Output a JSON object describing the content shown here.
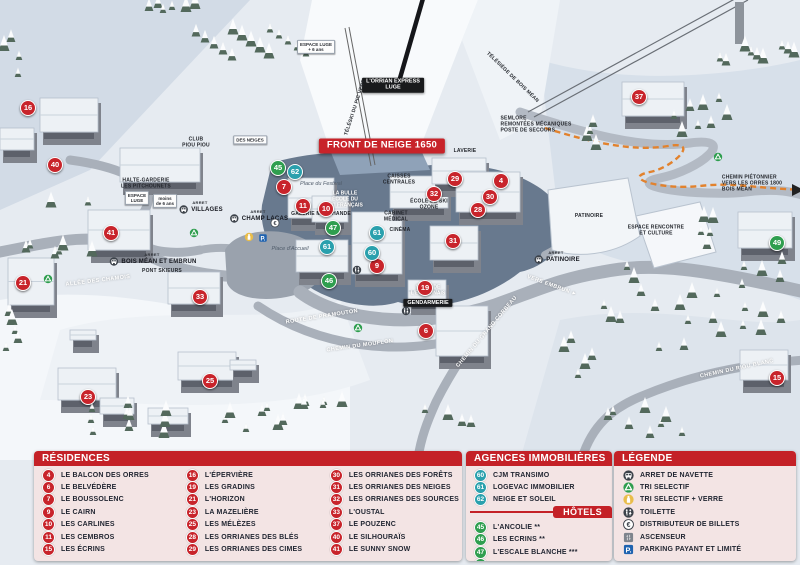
{
  "map": {
    "banner": "FRONT DE NEIGE 1650",
    "colors": {
      "residence_marker": "#c8242b",
      "agency_marker": "#2aa0ad",
      "hotel_marker": "#2f9e4f",
      "banner_red": "#c8232a",
      "pedestrian_path_orange": "#e2822d",
      "panel_pink": "#f3e4e4"
    },
    "markers": [
      {
        "n": "16",
        "kind": "residence",
        "x": 28,
        "y": 108
      },
      {
        "n": "40",
        "kind": "residence",
        "x": 55,
        "y": 165
      },
      {
        "n": "41",
        "kind": "residence",
        "x": 111,
        "y": 233
      },
      {
        "n": "21",
        "kind": "residence",
        "x": 23,
        "y": 283
      },
      {
        "n": "33",
        "kind": "residence",
        "x": 200,
        "y": 297
      },
      {
        "n": "23",
        "kind": "residence",
        "x": 88,
        "y": 397
      },
      {
        "n": "25",
        "kind": "residence",
        "x": 210,
        "y": 381
      },
      {
        "n": "7",
        "kind": "residence",
        "x": 284,
        "y": 187
      },
      {
        "n": "11",
        "kind": "residence",
        "x": 303,
        "y": 206
      },
      {
        "n": "10",
        "kind": "residence",
        "x": 326,
        "y": 209
      },
      {
        "n": "9",
        "kind": "residence",
        "x": 377,
        "y": 266
      },
      {
        "n": "19",
        "kind": "residence",
        "x": 425,
        "y": 288
      },
      {
        "n": "6",
        "kind": "residence",
        "x": 426,
        "y": 331
      },
      {
        "n": "31",
        "kind": "residence",
        "x": 453,
        "y": 241
      },
      {
        "n": "28",
        "kind": "residence",
        "x": 478,
        "y": 210
      },
      {
        "n": "30",
        "kind": "residence",
        "x": 490,
        "y": 197
      },
      {
        "n": "32",
        "kind": "residence",
        "x": 434,
        "y": 194
      },
      {
        "n": "29",
        "kind": "residence",
        "x": 455,
        "y": 179
      },
      {
        "n": "4",
        "kind": "residence",
        "x": 501,
        "y": 181
      },
      {
        "n": "37",
        "kind": "residence",
        "x": 639,
        "y": 97
      },
      {
        "n": "15",
        "kind": "residence",
        "x": 777,
        "y": 378
      },
      {
        "n": "62",
        "kind": "agency",
        "x": 295,
        "y": 172
      },
      {
        "n": "61",
        "kind": "agency",
        "x": 377,
        "y": 233
      },
      {
        "n": "61",
        "kind": "agency",
        "x": 327,
        "y": 247
      },
      {
        "n": "60",
        "kind": "agency",
        "x": 372,
        "y": 253
      },
      {
        "n": "45",
        "kind": "hotel",
        "x": 278,
        "y": 168
      },
      {
        "n": "47",
        "kind": "hotel",
        "x": 333,
        "y": 228
      },
      {
        "n": "46",
        "kind": "hotel",
        "x": 329,
        "y": 281
      },
      {
        "n": "49",
        "kind": "hotel",
        "x": 777,
        "y": 243
      }
    ],
    "labels": [
      {
        "lines": [
          "FRONT DE NEIGE 1650"
        ],
        "style": "banner",
        "x": 382,
        "y": 146
      },
      {
        "lines": [
          "L'ORRIAN EXPRESS",
          "LUGE"
        ],
        "style": "blackbox",
        "x": 393,
        "y": 85
      },
      {
        "lines": [
          "TÉLÉSKI DU PIC VERT"
        ],
        "style": "dark",
        "x": 356,
        "y": 108,
        "rot": -72
      },
      {
        "lines": [
          "TÉLÉSIÈGE DE BOIS MÉAN"
        ],
        "style": "dark",
        "x": 512,
        "y": 78,
        "rot": 44
      },
      {
        "lines": [
          "SEMLORE",
          "REMONTÉES MÉCANIQUES",
          "POSTE DE SECOURS"
        ],
        "style": "darkleft",
        "x": 536,
        "y": 125
      },
      {
        "lines": [
          "LAVERIE"
        ],
        "style": "dark",
        "x": 465,
        "y": 152
      },
      {
        "lines": [
          "CAISSES",
          "CENTRALES"
        ],
        "style": "dark",
        "x": 399,
        "y": 180
      },
      {
        "lines": [
          "ÉCOLE DE SKI",
          "OZONE"
        ],
        "style": "dark",
        "x": 429,
        "y": 205
      },
      {
        "lines": [
          "CABINET",
          "MÉDICAL"
        ],
        "style": "dark",
        "x": 396,
        "y": 217
      },
      {
        "lines": [
          "CINÉMA"
        ],
        "style": "dark",
        "x": 400,
        "y": 231
      },
      {
        "lines": [
          "LA BULLE",
          "ÉCOLE DU",
          "SKI FRANÇAIS"
        ],
        "style": "white",
        "x": 345,
        "y": 200
      },
      {
        "lines": [
          "GALERIE MARCHANDE"
        ],
        "style": "dark",
        "x": 321,
        "y": 215
      },
      {
        "lines": [
          "Place du Festival"
        ],
        "style": "italic",
        "x": 321,
        "y": 184
      },
      {
        "lines": [
          "Place d'Accueil"
        ],
        "style": "italic",
        "x": 290,
        "y": 249
      },
      {
        "lines": [
          "HALTE-GARDERIE",
          "LES PITCHOUNETS"
        ],
        "style": "dark",
        "x": 146,
        "y": 184
      },
      {
        "lines": [
          "ESPACE",
          "LUGE"
        ],
        "style": "sign",
        "x": 137,
        "y": 198
      },
      {
        "lines": [
          "moins",
          "de 6 ans"
        ],
        "style": "sign",
        "x": 165,
        "y": 201
      },
      {
        "lines": [
          "ESPACE LUGE",
          "+ 6 ans"
        ],
        "style": "sign",
        "x": 316,
        "y": 47
      },
      {
        "lines": [
          "CLUB",
          "PIOU PIOU"
        ],
        "style": "dark",
        "x": 196,
        "y": 143
      },
      {
        "lines": [
          "DES NEIGES"
        ],
        "style": "sign",
        "x": 250,
        "y": 140
      },
      {
        "lines": [
          "ALLÉE DES CHAMOIS"
        ],
        "style": "road",
        "x": 98,
        "y": 281,
        "rot": -7
      },
      {
        "lines": [
          "PONT SKIEURS"
        ],
        "style": "dark",
        "x": 162,
        "y": 272
      },
      {
        "lines": [
          "ROUTE DE PRAMOUTON"
        ],
        "style": "road",
        "x": 322,
        "y": 317,
        "rot": -9
      },
      {
        "lines": [
          "CHEMIN DU MOUFLON"
        ],
        "style": "road",
        "x": 360,
        "y": 346,
        "rot": -8
      },
      {
        "lines": [
          "CHEMIN DU GRAND CORBEAU"
        ],
        "style": "road",
        "x": 487,
        "y": 332,
        "rot": -50
      },
      {
        "lines": [
          "VERS EMBRUN ►"
        ],
        "style": "road",
        "x": 552,
        "y": 286,
        "rot": 20
      },
      {
        "lines": [
          "CHEMIN PIÉTONNIER",
          "VERS LES ORRES 1800",
          "BOIS MÉAN"
        ],
        "style": "darkleft",
        "x": 752,
        "y": 184
      },
      {
        "lines": [
          "CHEMIN DU RIOU BLANC"
        ],
        "style": "road",
        "x": 737,
        "y": 369,
        "rot": -12
      },
      {
        "lines": [
          "ESPACE RENCONTRE",
          "ET CULTURE"
        ],
        "style": "dark",
        "x": 656,
        "y": 231
      },
      {
        "lines": [
          "PATINOIRE"
        ],
        "style": "dark",
        "x": 589,
        "y": 217
      },
      {
        "lines": [
          "SALLE DE",
          "L'EMBRUNAIS"
        ],
        "style": "white",
        "x": 428,
        "y": 291
      },
      {
        "lines": [
          "GENDARMERIE"
        ],
        "style": "blackbox",
        "x": 428,
        "y": 303
      }
    ],
    "bus_stops": [
      {
        "arret": "ARRET",
        "name": "VILLAGES",
        "x": 200,
        "y": 207
      },
      {
        "arret": "ARRET",
        "name": "CHAMP LACAS",
        "x": 258,
        "y": 216
      },
      {
        "arret": "ARRET",
        "name": "BOIS MÉAN ET EMBRUN",
        "x": 152,
        "y": 259
      },
      {
        "arret": "ARRET",
        "name": "PATINOIRE",
        "x": 556,
        "y": 257
      }
    ],
    "map_icons": [
      {
        "type": "recycle-icon",
        "x": 194,
        "y": 233
      },
      {
        "type": "recycle-icon",
        "x": 48,
        "y": 279
      },
      {
        "type": "recycle-icon",
        "x": 718,
        "y": 157
      },
      {
        "type": "recycle-icon",
        "x": 358,
        "y": 328
      },
      {
        "type": "glass-icon",
        "x": 249,
        "y": 237
      },
      {
        "type": "parking-icon",
        "x": 263,
        "y": 238
      },
      {
        "type": "atm-icon",
        "x": 275,
        "y": 223
      },
      {
        "type": "toilet-icon",
        "x": 357,
        "y": 270
      },
      {
        "type": "toilet-icon",
        "x": 406,
        "y": 311
      }
    ]
  },
  "legend": {
    "residences": {
      "title": "RÉSIDENCES",
      "columns": [
        [
          {
            "n": "4",
            "label": "LE BALCON DES ORRES"
          },
          {
            "n": "6",
            "label": "LE BELVÉDÈRE"
          },
          {
            "n": "7",
            "label": "LE BOUSSOLENC"
          },
          {
            "n": "9",
            "label": "LE CAIRN"
          },
          {
            "n": "10",
            "label": "LES CARLINES"
          },
          {
            "n": "11",
            "label": "LES CEMBROS"
          },
          {
            "n": "15",
            "label": "LES ÉCRINS"
          }
        ],
        [
          {
            "n": "16",
            "label": "L'ÉPERVIÈRE"
          },
          {
            "n": "19",
            "label": "LES GRADINS"
          },
          {
            "n": "21",
            "label": "L'HORIZON"
          },
          {
            "n": "23",
            "label": "LA MAZELIÈRE"
          },
          {
            "n": "25",
            "label": "LES MÉLÈZES"
          },
          {
            "n": "28",
            "label": "LES ORRIANES DES BLÉS"
          },
          {
            "n": "29",
            "label": "LES ORRIANES DES CIMES"
          }
        ],
        [
          {
            "n": "30",
            "label": "LES ORRIANES DES FORÊTS"
          },
          {
            "n": "31",
            "label": "LES ORRIANES DES NEIGES"
          },
          {
            "n": "32",
            "label": "LES ORRIANES DES SOURCES"
          },
          {
            "n": "33",
            "label": "L'OUSTAL"
          },
          {
            "n": "37",
            "label": "LE POUZENC"
          },
          {
            "n": "40",
            "label": "LE SILHOURAÏS"
          },
          {
            "n": "41",
            "label": "LE SUNNY SNOW"
          }
        ]
      ]
    },
    "agencies": {
      "title": "AGENCES IMMOBILIÈRES",
      "items": [
        {
          "n": "60",
          "label": "CJM TRANSIMO"
        },
        {
          "n": "61",
          "label": "LOGEVAC IMMOBILIER"
        },
        {
          "n": "62",
          "label": "NEIGE ET SOLEIL"
        }
      ]
    },
    "hotels": {
      "title": "HÔTELS",
      "items": [
        {
          "n": "45",
          "label": "L'ANCOLIE **"
        },
        {
          "n": "46",
          "label": "LES ECRINS **"
        },
        {
          "n": "47",
          "label": "L'ESCALE BLANCHE ***"
        },
        {
          "n": "49",
          "label": "LES TRAPPEURS **"
        }
      ]
    },
    "key": {
      "title": "LÉGENDE",
      "items": [
        {
          "icon": "bus-icon",
          "label": "ARRET DE NAVETTE"
        },
        {
          "icon": "recycle-icon",
          "label": "TRI SELECTIF"
        },
        {
          "icon": "glass-icon",
          "label": "TRI SELECTIF + VERRE"
        },
        {
          "icon": "toilet-icon",
          "label": "TOILETTE"
        },
        {
          "icon": "atm-icon",
          "label": "DISTRIBUTEUR DE BILLETS"
        },
        {
          "icon": "elevator-icon",
          "label": "ASCENSEUR"
        },
        {
          "icon": "parking-icon",
          "label": "PARKING PAYANT ET LIMITÉ"
        }
      ]
    }
  }
}
